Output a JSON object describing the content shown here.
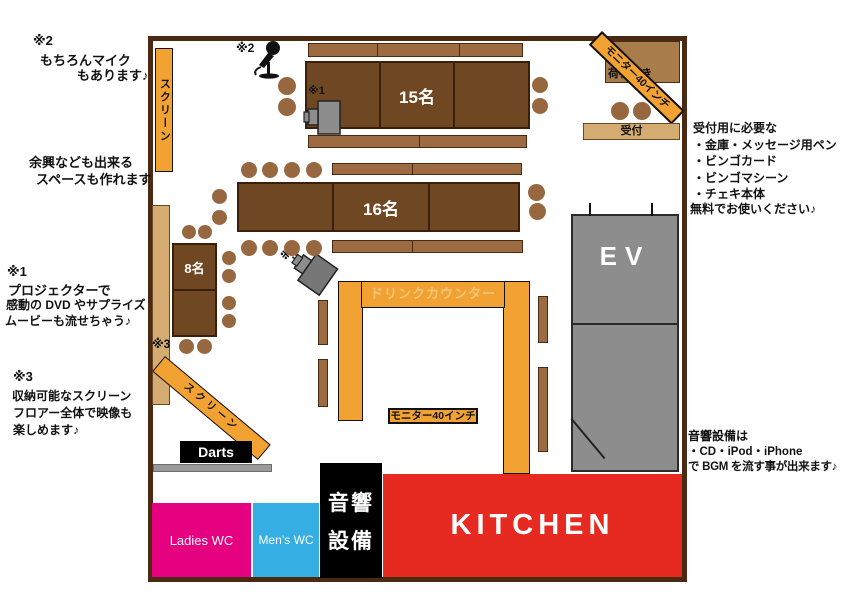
{
  "colors": {
    "wall": "#4a2a13",
    "table": "#6f4823",
    "table_border": "#3a2008",
    "bench": "#9c6b42",
    "bench_border": "#4a2a13",
    "stool": "#976840",
    "orange": "#f2a232",
    "tan": "#d4ac72",
    "luggage": "#a97c4b",
    "ev_gray": "#8d8d8d",
    "bar_gray": "#9b9b9b",
    "pink": "#e5017f",
    "blue": "#35aee3",
    "red": "#e62a22",
    "counter_text": "#f0c678"
  },
  "room": {
    "tables": {
      "table15": "15名",
      "table16": "16名",
      "table8": "8名"
    },
    "fixtures": {
      "screen_left": "スクリーン",
      "screen_diag": "スクリーン",
      "monitor_banner": "モニター40インチ",
      "monitor_box": "モニター40インチ",
      "luggage_shelf": "荷物置き",
      "reception_desk": "受付",
      "drink_counter": "ドリンクカウンター",
      "elevator": "EV",
      "darts": "Darts",
      "ladies_wc": "Ladies WC",
      "mens_wc": "Men’s WC",
      "sound_room_line1": "音響",
      "sound_room_line2": "設備",
      "kitchen": "KITCHEN"
    },
    "markers": {
      "m1": "※1",
      "m2": "※2",
      "m3": "※3"
    }
  },
  "annotations": {
    "mic": {
      "marker": "※2",
      "line1": "もちろんマイク",
      "line2": "もあります♪"
    },
    "space": {
      "line1": "余興なども出来る",
      "line2": "スペースも作れます"
    },
    "projector": {
      "marker": "※1",
      "line1": "プロジェクターで",
      "line2": "感動の DVD やサプライズ",
      "line3": "ムービーも流せちゃう♪"
    },
    "screen": {
      "marker": "※3",
      "line1": "収納可能なスクリーン",
      "line2": "フロアー全体で映像も",
      "line3": "楽しめます♪"
    },
    "reception": {
      "line1": "受付用に必要な",
      "line2": "・金庫・メッセージ用ペン",
      "line3": "・ビンゴカード",
      "line4": "・ビンゴマシーン",
      "line5": "・チェキ本体",
      "line6": "無料でお使いください♪"
    },
    "sound": {
      "line1": "音響設備は",
      "line2": "・CD・iPod・iPhone",
      "line3": "で BGM を流す事が出来ます♪"
    }
  }
}
